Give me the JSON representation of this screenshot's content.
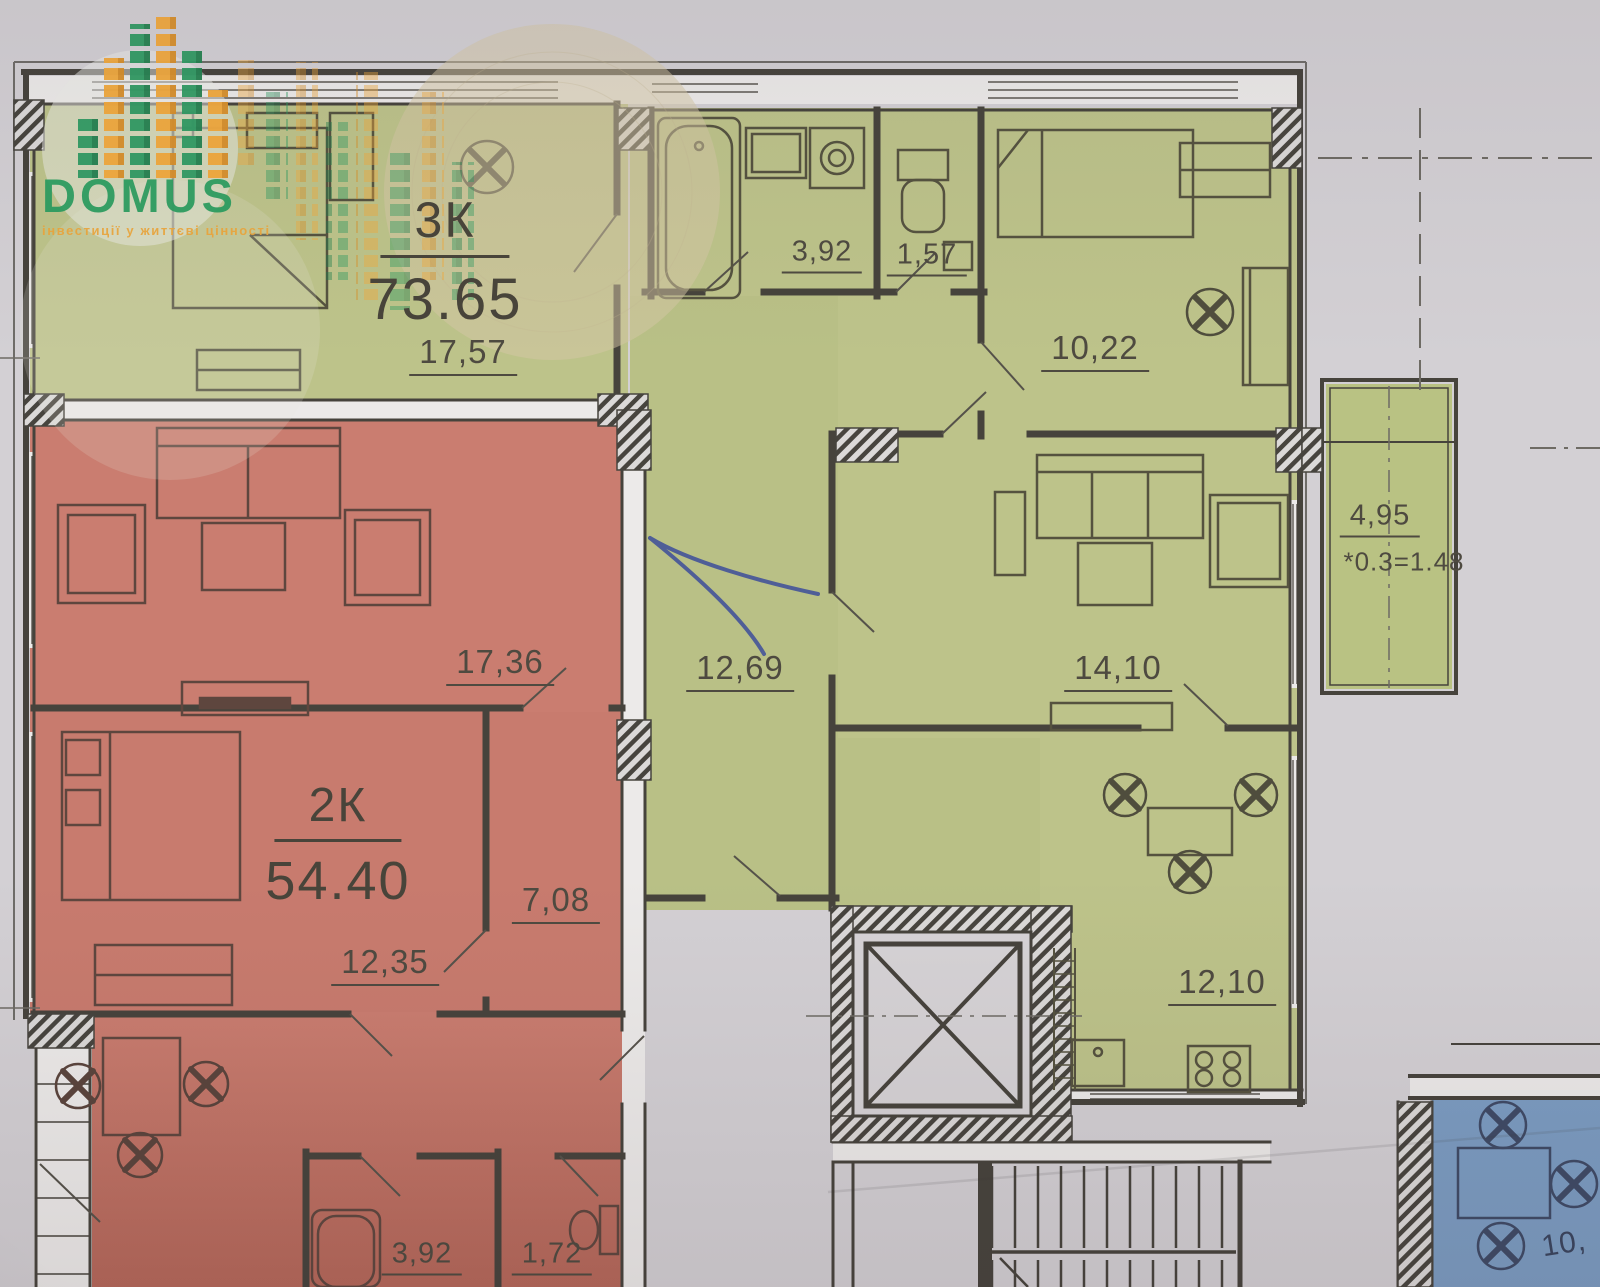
{
  "logo": {
    "brand": "DOMUS",
    "tagline": "інвестиції у життєві цінності",
    "brand_color": "#2a9d5f",
    "accent_color": "#f2a93b"
  },
  "plan": {
    "apartment_3k": {
      "type_label": "3К",
      "total_area": "73.65",
      "fill_color": "#bdc38a",
      "rooms": {
        "bedroom_1": "17,57",
        "bathroom": "3,92",
        "wc": "1,57",
        "bedroom_2": "10,22",
        "hall": "12,69",
        "living_room": "14,10",
        "kitchen": "12,10",
        "balcony": "4,95",
        "balcony_coefficient": "*0.3=1.48"
      }
    },
    "apartment_2k": {
      "type_label": "2К",
      "total_area": "54.40",
      "fill_color": "#c87b6e",
      "rooms": {
        "living_room": "17,36",
        "bedroom": "12,35",
        "corridor": "7,08",
        "bathroom": "3,92",
        "wc": "1,72"
      }
    },
    "apartment_blue_partial": {
      "visible_area_fragment": "10,",
      "fill_color": "#7b9cc2"
    }
  },
  "colors": {
    "paper": "#d3d0d4",
    "wall": "#46433c",
    "window_core": "#eceae9",
    "pen_annotation": "#3d4e9a"
  },
  "icons": {
    "chair": "circle-with-cross",
    "elevator_shaft": "crossed-square",
    "staircase": "parallel-treads",
    "bathtub": "rounded-rect-double",
    "toilet": "tank-and-bowl",
    "washing_machine": "square-with-circle",
    "kitchen_sink": "square-basin",
    "stove": "four-burner-grid"
  }
}
